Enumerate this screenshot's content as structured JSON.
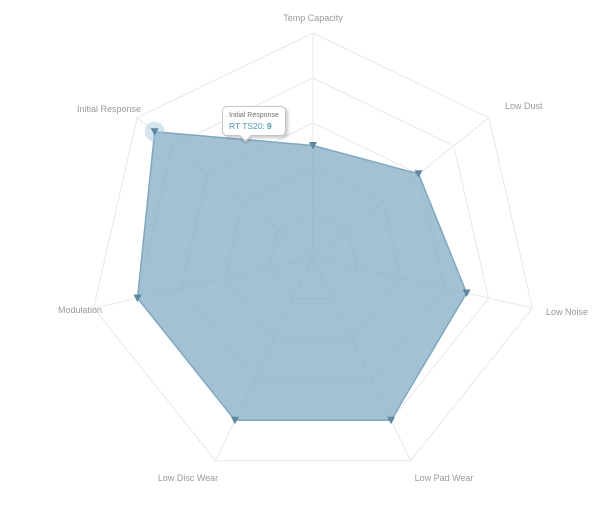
{
  "chart": {
    "background": "#ffffff"
  },
  "chart_data": {
    "type": "radar",
    "title": "",
    "categories": [
      "Temp Capacity",
      "Low Dust",
      "Low Noise",
      "Low Pad Wear",
      "Low Disc Wear",
      "Modulation",
      "Initial Response"
    ],
    "series": [
      {
        "name": "RT TS20",
        "values": [
          5,
          6,
          7,
          8,
          8,
          8,
          9
        ]
      }
    ],
    "scale": {
      "min": 0,
      "max": 10,
      "rings": 5
    },
    "grid_shape": "polygonal",
    "legend": "none",
    "highlighted_point": {
      "category": "Initial Response",
      "value": 9
    },
    "colors": {
      "area_fill": "#7fa9c2",
      "area_fill_opacity": 0.72,
      "area_stroke": "#7fa8c0",
      "marker": "#5e87a0",
      "halo": "#9fc6da",
      "halo_opacity": 0.45,
      "grid_line": "#e8e8e8",
      "axis_label": "#9a9a9a"
    }
  },
  "tooltip": {
    "visible": true,
    "category": "Initial Response",
    "series_label": "RT TS20:",
    "value": "9",
    "value_color": "#4d96ad"
  }
}
